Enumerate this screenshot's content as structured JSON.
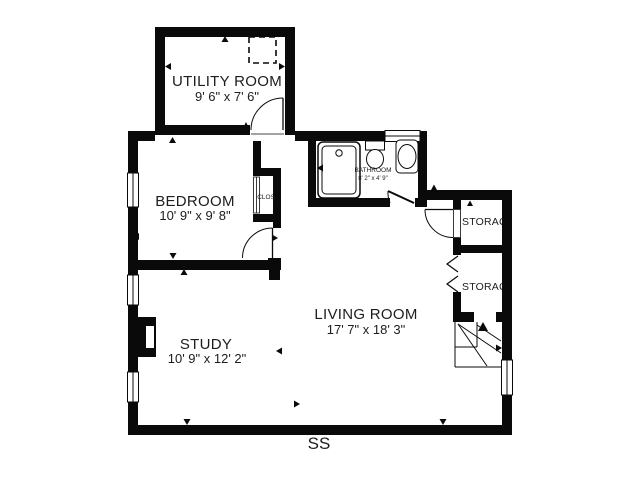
{
  "page": {
    "background_color": "#ffffff",
    "wall_color": "#0a0a0a",
    "text_color": "#1d1d1d"
  },
  "rooms": {
    "utility": {
      "name": "UTILITY ROOM",
      "dims": "9' 6\" x 7' 6\""
    },
    "bedroom": {
      "name": "BEDROOM",
      "dims": "10' 9\" x 9' 8\""
    },
    "closet": {
      "name": "CLOS."
    },
    "bathroom": {
      "name": "BATHROOM",
      "dims": "8' 2\" x 4' 9\""
    },
    "storage_top": {
      "name": "STORAGE"
    },
    "storage_bottom": {
      "name": "STORAGE"
    },
    "living": {
      "name": "LIVING ROOM",
      "dims": "17' 7\" x 18' 3\""
    },
    "study": {
      "name": "STUDY",
      "dims": "10' 9\" x 12' 2\""
    }
  },
  "footer": {
    "label": "SS"
  }
}
